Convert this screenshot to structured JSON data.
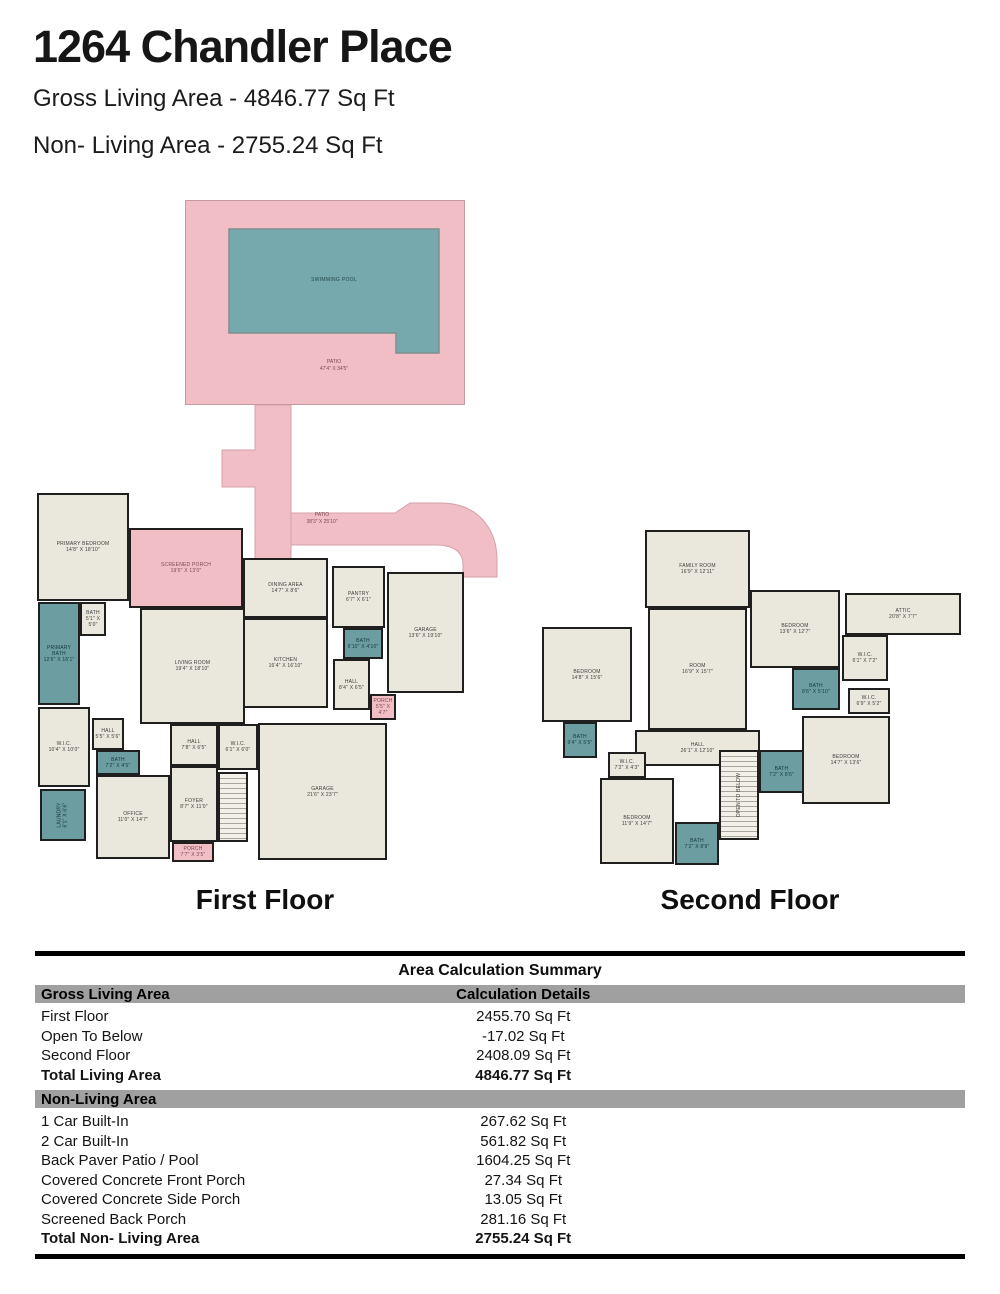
{
  "header": {
    "title": "1264 Chandler Place",
    "gross_living": "Gross Living Area - 4846.77 Sq Ft",
    "non_living": "Non- Living Area - 2755.24 Sq Ft"
  },
  "pool_area": {
    "pool_label": "SWIMMING POOL",
    "patio_label": "PATIO",
    "patio_dims": "47'4\" X 34'5\"",
    "path_label": "PATIO",
    "path_dims": "38'3\" X 25'10\""
  },
  "colors": {
    "patio_pink": "#f0bec4",
    "pool_teal": "#76a9ad",
    "room_beige": "#eae8dc",
    "bath_teal": "#6b9da1",
    "wall_dark": "#1f1f1f",
    "band_gray": "#a0a0a0"
  },
  "floors": {
    "first": {
      "caption": "First Floor",
      "rooms": [
        {
          "id": "primary-bedroom",
          "name": "PRIMARY BEDROOM",
          "dims": "14'8\" X 18'10\"",
          "type": "room",
          "x": 7,
          "y": 3,
          "w": 92,
          "h": 108
        },
        {
          "id": "screened-porch",
          "name": "SCREENED PORCH",
          "dims": "19'0\" X 13'0\"",
          "type": "porch",
          "x": 99,
          "y": 38,
          "w": 114,
          "h": 80
        },
        {
          "id": "primary-bath",
          "name": "PRIMARY BATH",
          "dims": "12'6\" X 16'1\"",
          "type": "bath",
          "x": 8,
          "y": 112,
          "w": 42,
          "h": 103
        },
        {
          "id": "bath-small",
          "name": "BATH",
          "dims": "5'1\" X 5'0\"",
          "type": "room",
          "x": 50,
          "y": 112,
          "w": 26,
          "h": 34
        },
        {
          "id": "wic",
          "name": "W.I.C.",
          "dims": "10'4\" X 10'0\"",
          "type": "room",
          "x": 8,
          "y": 217,
          "w": 52,
          "h": 80
        },
        {
          "id": "hall-small",
          "name": "HALL",
          "dims": "5'5\" X 5'6\"",
          "type": "room",
          "x": 62,
          "y": 228,
          "w": 32,
          "h": 32
        },
        {
          "id": "bath-2",
          "name": "BATH",
          "dims": "7'2\" X 4'5\"",
          "type": "bath",
          "x": 66,
          "y": 260,
          "w": 44,
          "h": 25
        },
        {
          "id": "laundry",
          "name": "LAUNDRY",
          "dims": "6'1\" X 6'6\"",
          "type": "bath",
          "vertical": true,
          "x": 10,
          "y": 299,
          "w": 46,
          "h": 52
        },
        {
          "id": "office",
          "name": "OFFICE",
          "dims": "11'0\" X 14'7\"",
          "type": "room",
          "x": 66,
          "y": 285,
          "w": 74,
          "h": 84
        },
        {
          "id": "living-room",
          "name": "LIVING ROOM",
          "dims": "19'4\" X 18'10\"",
          "type": "room",
          "x": 110,
          "y": 118,
          "w": 105,
          "h": 116
        },
        {
          "id": "dining-area",
          "name": "DINING AREA",
          "dims": "14'7\" X 8'6\"",
          "type": "room",
          "x": 213,
          "y": 68,
          "w": 85,
          "h": 60
        },
        {
          "id": "kitchen",
          "name": "KITCHEN",
          "dims": "16'4\" X 16'10\"",
          "type": "room",
          "x": 213,
          "y": 128,
          "w": 85,
          "h": 90
        },
        {
          "id": "pantry",
          "name": "PANTRY",
          "dims": "6'7\" X 6'1\"",
          "type": "room",
          "x": 302,
          "y": 76,
          "w": 53,
          "h": 62
        },
        {
          "id": "bath-3",
          "name": "BATH",
          "dims": "6'10\" X 4'10\"",
          "type": "bath",
          "x": 313,
          "y": 138,
          "w": 40,
          "h": 31
        },
        {
          "id": "garage-1-car",
          "name": "GARAGE",
          "dims": "13'6\" X 19'10\"",
          "type": "room",
          "x": 357,
          "y": 82,
          "w": 77,
          "h": 121
        },
        {
          "id": "hall-2",
          "name": "HALL",
          "dims": "8'4\" X 6'5\"",
          "type": "room",
          "x": 303,
          "y": 169,
          "w": 37,
          "h": 51
        },
        {
          "id": "porch-side",
          "name": "PORCH",
          "dims": "5'5\" X 4'7\"",
          "type": "porch",
          "x": 340,
          "y": 204,
          "w": 26,
          "h": 26
        },
        {
          "id": "hall-3",
          "name": "HALL",
          "dims": "7'8\" X 6'5\"",
          "type": "room",
          "x": 140,
          "y": 234,
          "w": 48,
          "h": 42
        },
        {
          "id": "wic-2",
          "name": "W.I.C.",
          "dims": "6'1\" X 6'0\"",
          "type": "room",
          "x": 188,
          "y": 234,
          "w": 40,
          "h": 46
        },
        {
          "id": "foyer",
          "name": "FOYER",
          "dims": "8'7\" X 11'0\"",
          "type": "room",
          "x": 140,
          "y": 276,
          "w": 48,
          "h": 76
        },
        {
          "id": "stairs-first",
          "name": "",
          "dims": "",
          "type": "stairs",
          "x": 188,
          "y": 282,
          "w": 30,
          "h": 70
        },
        {
          "id": "garage-2-car",
          "name": "GARAGE",
          "dims": "21'6\" X 23'7\"",
          "type": "room",
          "x": 228,
          "y": 233,
          "w": 129,
          "h": 137
        },
        {
          "id": "porch-front",
          "name": "PORCH",
          "dims": "7'7\" X 3'5\"",
          "type": "porch",
          "x": 142,
          "y": 352,
          "w": 42,
          "h": 20
        }
      ]
    },
    "second": {
      "caption": "Second Floor",
      "rooms": [
        {
          "id": "family-room",
          "name": "FAMILY ROOM",
          "dims": "16'9\" X 12'11\"",
          "type": "room",
          "x": 110,
          "y": 10,
          "w": 105,
          "h": 78
        },
        {
          "id": "room",
          "name": "ROOM",
          "dims": "16'9\" X 15'7\"",
          "type": "room",
          "x": 113,
          "y": 88,
          "w": 99,
          "h": 122
        },
        {
          "id": "bedroom-2",
          "name": "BEDROOM",
          "dims": "14'8\" X 15'6\"",
          "type": "room",
          "x": 7,
          "y": 107,
          "w": 90,
          "h": 95
        },
        {
          "id": "bedroom-3",
          "name": "BEDROOM",
          "dims": "13'6\" X 12'7\"",
          "type": "room",
          "x": 215,
          "y": 70,
          "w": 90,
          "h": 78
        },
        {
          "id": "attic",
          "name": "ATTIC",
          "dims": "20'8\" X 7'7\"",
          "type": "room",
          "x": 310,
          "y": 73,
          "w": 116,
          "h": 42
        },
        {
          "id": "wic-3",
          "name": "W.I.C.",
          "dims": "6'1\" X 7'2\"",
          "type": "room",
          "x": 307,
          "y": 115,
          "w": 46,
          "h": 46
        },
        {
          "id": "bath-4",
          "name": "BATH",
          "dims": "8'6\" X 5'10\"",
          "type": "bath",
          "x": 257,
          "y": 148,
          "w": 48,
          "h": 42
        },
        {
          "id": "wic-4",
          "name": "W.I.C.",
          "dims": "6'9\" X 5'2\"",
          "type": "room",
          "x": 313,
          "y": 168,
          "w": 42,
          "h": 26
        },
        {
          "id": "bedroom-4",
          "name": "BEDROOM",
          "dims": "14'7\" X 13'6\"",
          "type": "room",
          "x": 267,
          "y": 196,
          "w": 88,
          "h": 88
        },
        {
          "id": "hall-4",
          "name": "HALL",
          "dims": "26'1\" X 12'10\"",
          "type": "room",
          "x": 100,
          "y": 210,
          "w": 125,
          "h": 36
        },
        {
          "id": "bath-5",
          "name": "BATH",
          "dims": "9'4\" X 5'5\"",
          "type": "bath",
          "x": 28,
          "y": 202,
          "w": 34,
          "h": 36
        },
        {
          "id": "wic-5",
          "name": "W.I.C.",
          "dims": "7'2\" X 4'3\"",
          "type": "room",
          "x": 73,
          "y": 232,
          "w": 38,
          "h": 26
        },
        {
          "id": "bedroom-5",
          "name": "BEDROOM",
          "dims": "11'9\" X 14'7\"",
          "type": "room",
          "x": 65,
          "y": 258,
          "w": 74,
          "h": 86
        },
        {
          "id": "bath-6",
          "name": "BATH",
          "dims": "7'2\" X 8'9\"",
          "type": "bath",
          "x": 140,
          "y": 302,
          "w": 44,
          "h": 43
        },
        {
          "id": "bath-7",
          "name": "BATH",
          "dims": "7'2\" X 8'6\"",
          "type": "bath",
          "x": 224,
          "y": 230,
          "w": 45,
          "h": 43
        },
        {
          "id": "stairs-open",
          "name": "OPEN TO BELOW",
          "dims": "",
          "type": "stairs",
          "vertical": true,
          "x": 184,
          "y": 230,
          "w": 40,
          "h": 90
        }
      ]
    }
  },
  "table": {
    "title": "Area Calculation Summary",
    "col_header": "Calculation Details",
    "sections": [
      {
        "header": "Gross Living Area",
        "rows": [
          {
            "label": "First Floor",
            "value": "2455.70 Sq Ft"
          },
          {
            "label": "Open To Below",
            "value": "-17.02 Sq Ft"
          },
          {
            "label": "Second Floor",
            "value": "2408.09 Sq Ft"
          },
          {
            "label": "Total Living Area",
            "value": "4846.77 Sq Ft",
            "bold": true
          }
        ]
      },
      {
        "header": "Non-Living Area",
        "rows": [
          {
            "label": "1 Car Built-In",
            "value": "267.62 Sq Ft"
          },
          {
            "label": "2 Car Built-In",
            "value": "561.82 Sq Ft"
          },
          {
            "label": "Back Paver Patio / Pool",
            "value": "1604.25 Sq Ft"
          },
          {
            "label": "Covered Concrete Front Porch",
            "value": "27.34 Sq Ft"
          },
          {
            "label": "Covered Concrete Side Porch",
            "value": "13.05 Sq Ft"
          },
          {
            "label": "Screened Back Porch",
            "value": "281.16 Sq Ft"
          },
          {
            "label": "Total Non- Living Area",
            "value": "2755.24 Sq Ft",
            "bold": true
          }
        ]
      }
    ]
  }
}
